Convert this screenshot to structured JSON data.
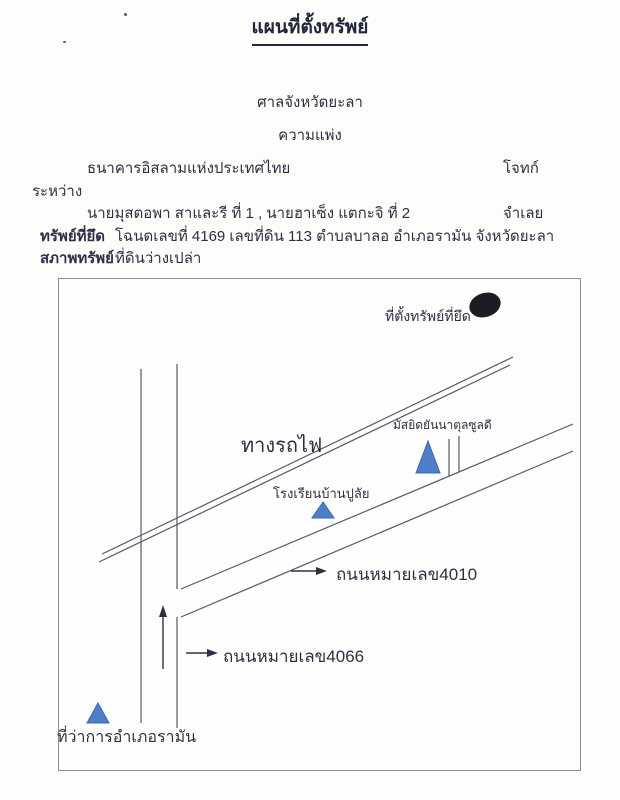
{
  "page": {
    "title": "แผนที่ตั้งทรัพย์"
  },
  "header": {
    "court": "ศาลจังหวัดยะลา",
    "case_type": "ความแพ่ง",
    "plaintiff": "ธนาคารอิสลามแห่งประเทศไทย",
    "plaintiff_role": "โจทก์",
    "between": "ระหว่าง",
    "defendant": "นายมุสตอพา สาและรี ที่ 1 , นายฮาเซ็ง แตกะจิ ที่ 2",
    "defendant_role": "จำเลย",
    "seized_property_label": "ทรัพย์ที่ยึด",
    "seized_property_value": "โฉนดเลขที่ 4169 เลขที่ดิน 113 ตำบลบาลอ อำเภอรามัน จังหวัดยะลา",
    "property_condition_label": "สภาพทรัพย์",
    "property_condition_value": "ที่ดินว่างเปล่า"
  },
  "map": {
    "property_marker_label": "ที่ตั้งทรัพย์ที่ยึด",
    "railway_label": "ทางรถไฟ",
    "mosque_label": "มัสยิดยันนาตุลซูลดี",
    "school_label": "โรงเรียนบ้านปูลัย",
    "road_4010_label": "ถนนหมายเลข4010",
    "road_4066_label": "ถนนหมายเลข4066",
    "district_office_label": "ที่ว่าการอำเภอรามัน",
    "marker_color": "#4d7fc9",
    "marker_edge_color": "#3a66b0",
    "property_marker_color": "#1c1c24",
    "line_color": "#555a66"
  }
}
